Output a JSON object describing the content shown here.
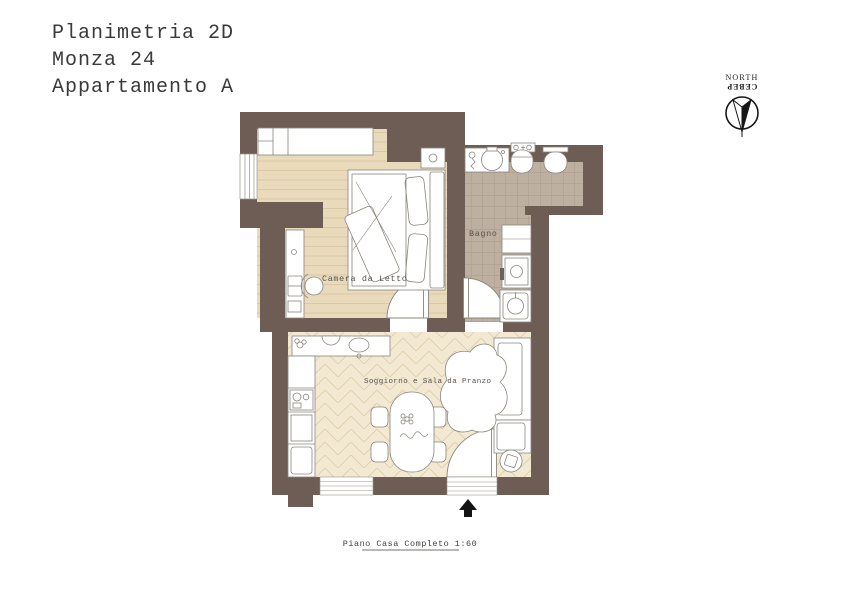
{
  "title": {
    "lines": [
      "Planimetria 2D",
      "Monza 24",
      "Appartamento A"
    ]
  },
  "compass": {
    "north_label": "NORTH",
    "north_label_cyrillic": "СЕВЕР"
  },
  "plan": {
    "rooms": [
      {
        "id": "bedroom",
        "label": "Camera da Letto"
      },
      {
        "id": "bathroom",
        "label": "Bagno"
      },
      {
        "id": "living",
        "label": "Soggiorno e Sala da Pranzo"
      }
    ],
    "caption": "Piano Casa Completo 1:60"
  },
  "colors": {
    "paper": "#ffffff",
    "wall": "#6e5d55",
    "bedroom_floor": "#e9dabb",
    "bedroom_floor_line": "#d8c4a0",
    "bathroom_floor": "#bdb0a1",
    "bathroom_floor_line": "#a79a8c",
    "living_floor": "#f3e9d3",
    "living_floor_line": "#dccfae",
    "furniture_stroke": "#8b867d",
    "label_text": "#57514b",
    "arrow": "#141414"
  }
}
